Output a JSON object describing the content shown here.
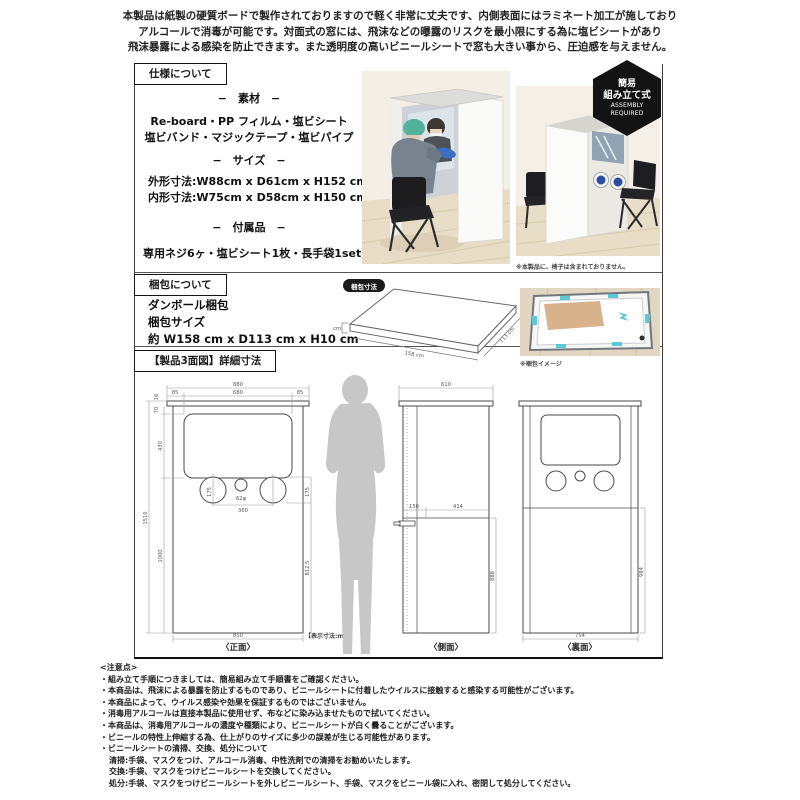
{
  "intro": {
    "line1": "本製品は紙製の硬質ボードで製作されておりますので軽く非常に丈夫です、内側表面にはラミネート加工が施しており",
    "line2": "アルコールで消毒が可能です。対面式の窓には、飛沫などの曝露のリスクを最小限にする為に塩ビシートがあり",
    "line3": "飛沫暴露による感染を防止できます。また透明度の高いビニールシートで窓も大きい事から、圧迫感を与えません。"
  },
  "spec": {
    "box_label": "仕様について",
    "material_heading": "−　素材　−",
    "material_line1": "Re-board・PP フィルム・塩ビシート",
    "material_line2": "塩ビバンド・マジックテープ・塩ビパイプ",
    "size_heading": "−　サイズ　−",
    "size_line1": "外形寸法:W88cm  x  D61cm x H152 cm",
    "size_line2": "内形寸法:W75cm  x  D58cm x H150 cm",
    "acc_heading": "−　付属品　−",
    "acc_line": "専用ネジ6ヶ・塩ビシート1枚・長手袋1set"
  },
  "photos": {
    "caption_chair": "※本製品に、椅子は含まれておりません。"
  },
  "badge": {
    "line1": "簡易",
    "line2": "組み立て式",
    "line3": "ASSEMBLY",
    "line4": "REQUIRED"
  },
  "packing": {
    "box_label": "梱包について",
    "line1": "ダンボール梱包",
    "line2": "梱包サイズ",
    "line3": "約 W158 cm x D113 cm x H10 cm",
    "diagram_badge": "梱包寸法",
    "dim_h": "10 cm",
    "dim_w": "158 cm",
    "dim_d": "113 cm",
    "photo_caption": "※梱包イメージ"
  },
  "drawing": {
    "box_label": "【製品3面図】詳細寸法",
    "unit_note": "【表示寸法:mm】",
    "front": {
      "label": "〈正面〉",
      "w_total": "880",
      "w_left": "85",
      "w_mid": "680",
      "w_right": "85",
      "h_cap": "70",
      "h_cap2": "16",
      "h_window": "430",
      "h_total": "1516",
      "h_lower": "1000",
      "w_bottom": "850",
      "d_circle": "175",
      "d_hole": "62φ",
      "w_pitch": "360",
      "d_circle_r": "175",
      "h_right": "812.5"
    },
    "side": {
      "label": "〈側面〉",
      "w_top": "610",
      "w_seg1": "150",
      "w_seg2": "414",
      "h_right": "888"
    },
    "back": {
      "label": "〈裏面〉",
      "w_bottom": "754",
      "h_right": "984"
    }
  },
  "notes": {
    "title": "<注意点>",
    "items": [
      "・組み立て手順につきましては、簡易組み立て手順書をご確認ください。",
      "・本商品は、飛沫による暴露を防止するものであり、ビニールシートに付着したウイルスに接触すると感染する可能性がございます。",
      "・本商品によって、ウイルス感染や効果を保証するものではございません。",
      "・消毒用アルコールは直接本製品に使用せず、布などに染み込ませたもので拭いてください。",
      "・本商品は、消毒用アルコールの濃度や種類により、ビニールシートが白く曇ることがございます。",
      "・ビニールの特性上伸縮する為、仕上がりのサイズに多少の誤差が生じる可能性があります。",
      "・ビニールシートの清掃、交換、処分について",
      "清掃:手袋、マスクをつけ、アルコール消毒、中性洗剤での清掃をお勧めいたします。",
      "交換:手袋、マスクをつけビニールシートを交換してください。",
      "処分:手袋、マスクをつけビニールシートを外しビニールシート、手袋、マスクをビニール袋に入れ、密閉して処分してください。"
    ]
  }
}
